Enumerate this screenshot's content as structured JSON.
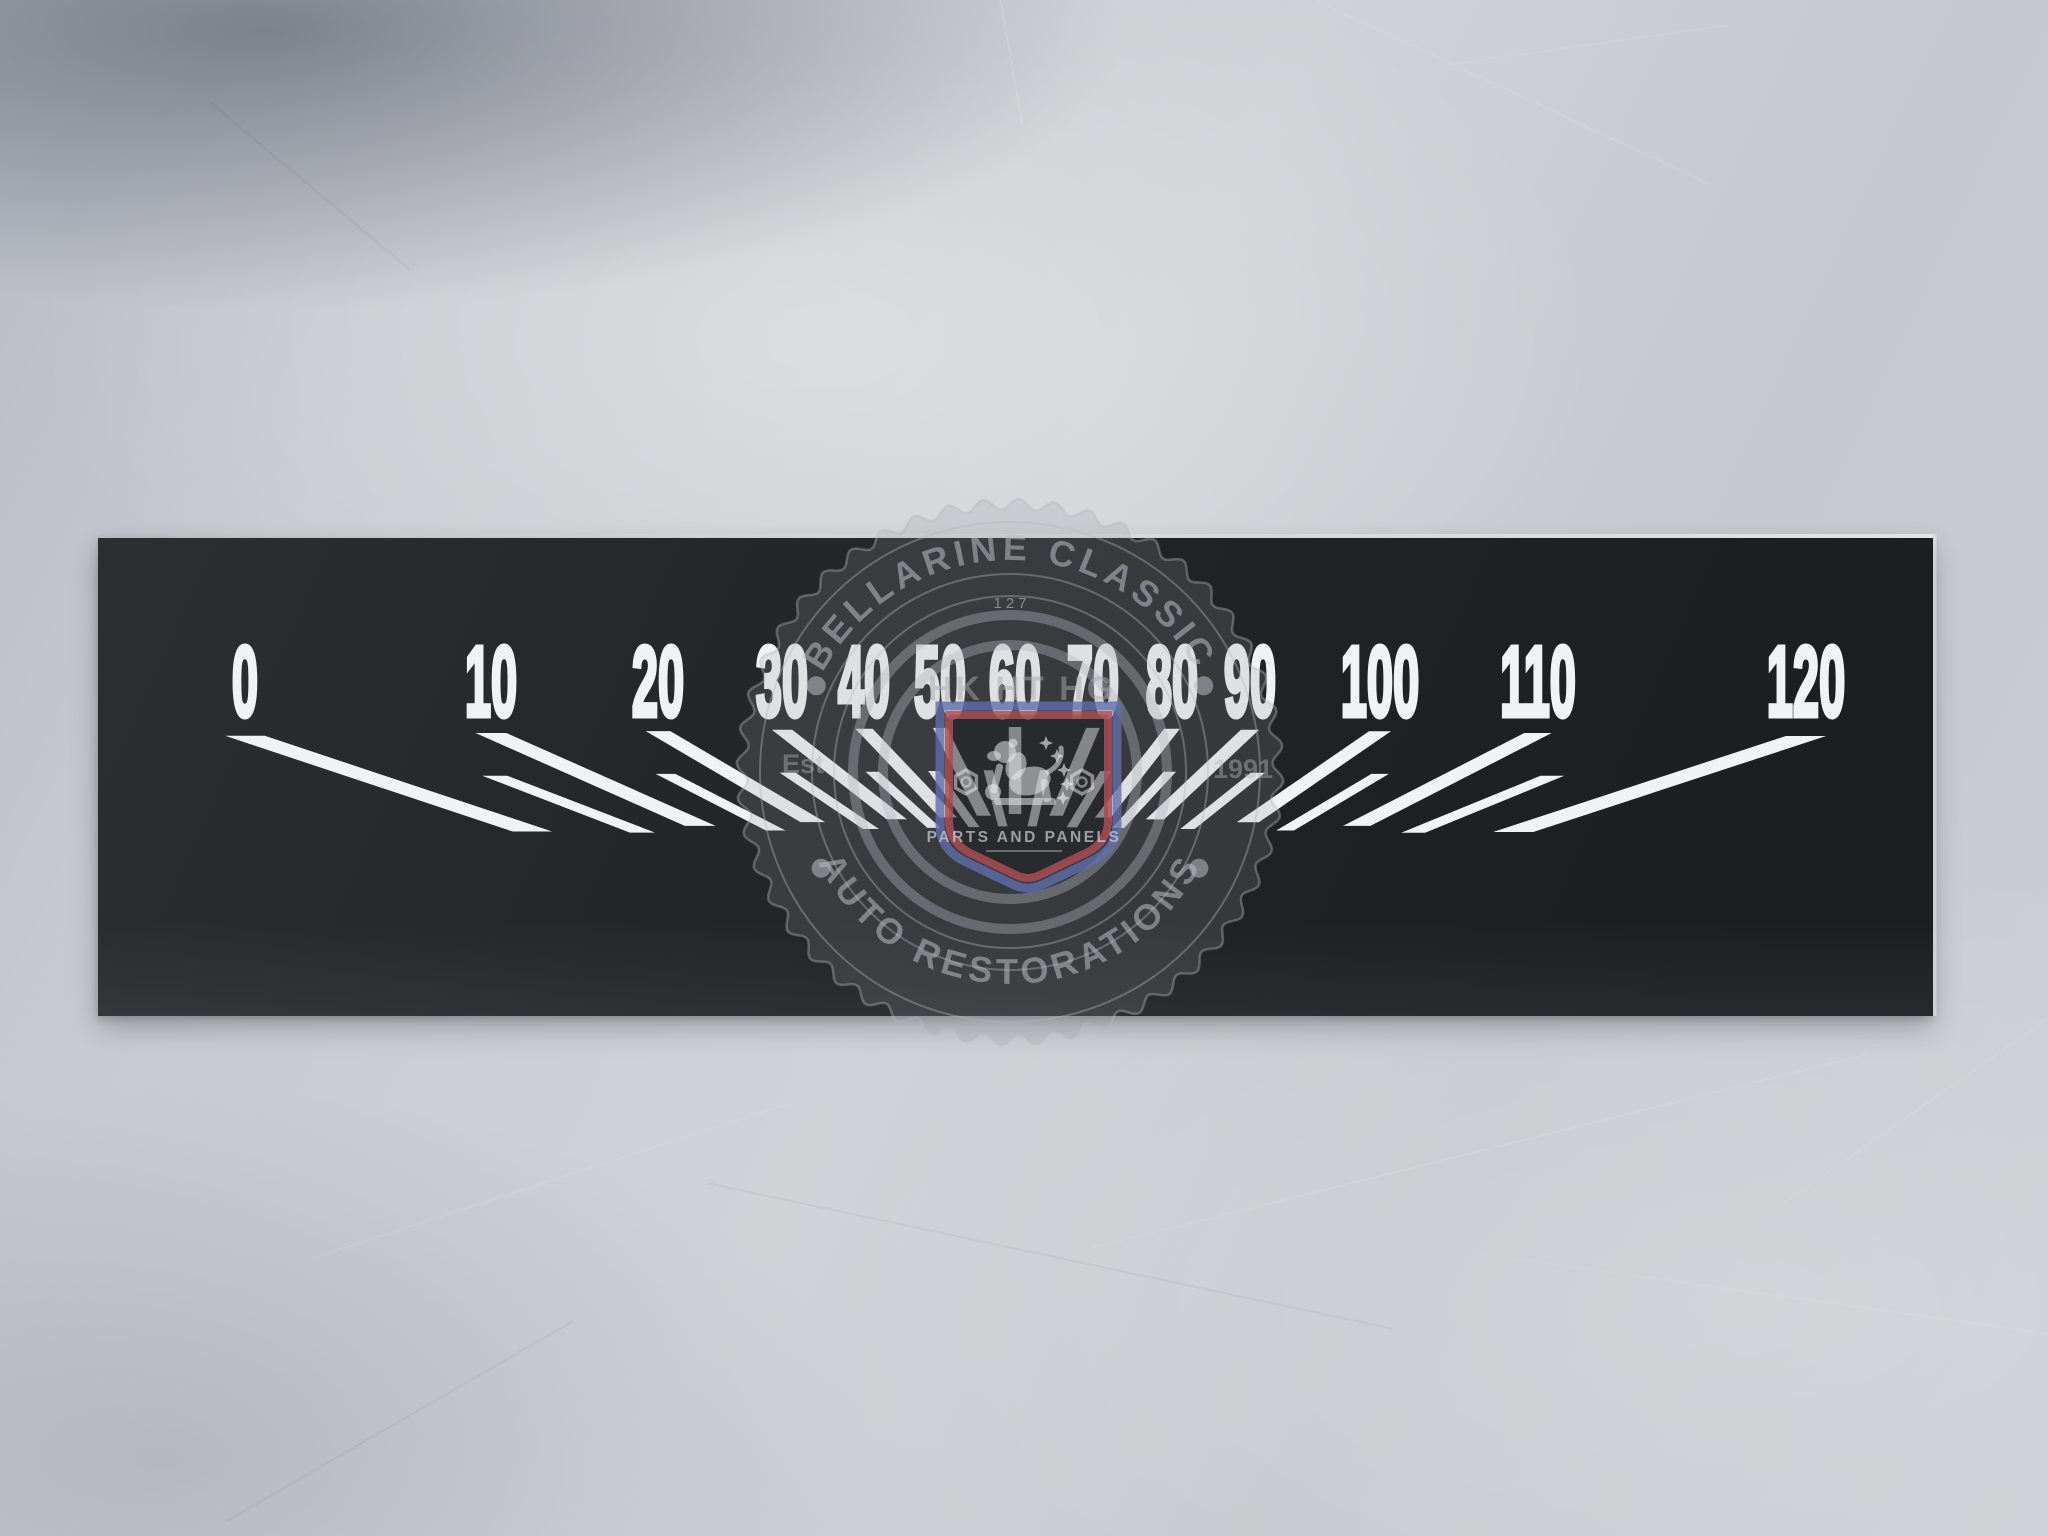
{
  "photo": {
    "subject": "speedometer faceplate decal photographed on brushed aluminium sheet",
    "colors": {
      "background_metal": "#c7cacf",
      "plate_black": "#222427",
      "markings_white": "#f1f2f3"
    }
  },
  "plate": {
    "scale": {
      "labels": [
        {
          "text": "0",
          "x": 245
        },
        {
          "text": "10",
          "x": 491
        },
        {
          "text": "20",
          "x": 658
        },
        {
          "text": "30",
          "x": 782
        },
        {
          "text": "40",
          "x": 864
        },
        {
          "text": "50",
          "x": 940
        },
        {
          "text": "60",
          "x": 1015
        },
        {
          "text": "70",
          "x": 1093
        },
        {
          "text": "80",
          "x": 1172
        },
        {
          "text": "90",
          "x": 1250
        },
        {
          "text": "100",
          "x": 1380
        },
        {
          "text": "110",
          "x": 1538
        },
        {
          "text": "120",
          "x": 1806
        }
      ],
      "ticks": [
        {
          "v": 0,
          "x": 245,
          "slope": 3.0,
          "major": true
        },
        {
          "v": 5,
          "x": 368,
          "slope": 2.6,
          "major": false
        },
        {
          "v": 10,
          "x": 491,
          "slope": 2.25,
          "major": true
        },
        {
          "v": 15,
          "x": 574,
          "slope": 1.95,
          "major": false
        },
        {
          "v": 20,
          "x": 658,
          "slope": 1.7,
          "major": true
        },
        {
          "v": 25,
          "x": 720,
          "slope": 1.48,
          "major": false
        },
        {
          "v": 30,
          "x": 782,
          "slope": 1.28,
          "major": true
        },
        {
          "v": 35,
          "x": 823,
          "slope": 1.1,
          "major": false
        },
        {
          "v": 40,
          "x": 864,
          "slope": 0.95,
          "major": true
        },
        {
          "v": 45,
          "x": 902,
          "slope": 0.72,
          "major": false
        },
        {
          "v": 50,
          "x": 940,
          "slope": 0.5,
          "major": true
        },
        {
          "v": 55,
          "x": 977,
          "slope": 0.26,
          "major": false
        },
        {
          "v": 60,
          "x": 1015,
          "slope": 0.0,
          "major": true
        },
        {
          "v": 65,
          "x": 1054,
          "slope": -0.22,
          "major": false
        },
        {
          "v": 70,
          "x": 1093,
          "slope": -0.42,
          "major": true
        },
        {
          "v": 75,
          "x": 1132,
          "slope": -0.6,
          "major": false
        },
        {
          "v": 80,
          "x": 1172,
          "slope": -0.78,
          "major": true
        },
        {
          "v": 85,
          "x": 1211,
          "slope": -0.92,
          "major": false
        },
        {
          "v": 90,
          "x": 1250,
          "slope": -1.06,
          "major": true
        },
        {
          "v": 95,
          "x": 1315,
          "slope": -1.25,
          "major": false
        },
        {
          "v": 100,
          "x": 1380,
          "slope": -1.45,
          "major": true
        },
        {
          "v": 105,
          "x": 1459,
          "slope": -1.68,
          "major": false
        },
        {
          "v": 110,
          "x": 1538,
          "slope": -1.95,
          "major": true
        },
        {
          "v": 115,
          "x": 1672,
          "slope": -2.45,
          "major": false
        },
        {
          "v": 120,
          "x": 1806,
          "slope": -3.05,
          "major": true
        }
      ],
      "geometry": {
        "strip": {
          "x": 98,
          "y": 538,
          "w": 1835,
          "h": 478
        },
        "label_baseline_y": 716,
        "label_font_size": 100,
        "label_scale_x": 0.47,
        "major_top": 727,
        "major_top_spread": 9,
        "major_bot": 814,
        "major_bot_spread": 18,
        "minor_top": 770,
        "minor_top_spread": 7,
        "minor_bot": 826,
        "minor_bot_spread": 8,
        "major_thickness": 12.5,
        "minor_thickness": 9,
        "center_x": 1015,
        "half_span": 790
      }
    }
  },
  "watermark": {
    "arc_top_text": "BELLARINE CLASSIC",
    "arc_bottom_text": "AUTO RESTORATIONS",
    "serial_number": "127",
    "model_codes": "HK HT HG",
    "established_prefix": "Est",
    "established_year": "1991",
    "badge_caption": "PARTS AND PANELS",
    "center": {
      "x": 1010,
      "y": 772
    },
    "scallop": {
      "radius": 268,
      "amplitude": 5.5,
      "teeth": 48
    },
    "thin_ring_radii": [
      250,
      198,
      176
    ],
    "bold_ring_radii": [
      157,
      127
    ],
    "text_ring_radius": 212,
    "bullet_angles_deg": [
      156,
      24,
      207,
      333
    ],
    "colors": {
      "mark_fill": "rgba(150,154,160,0.20)",
      "mark_line": "rgba(180,185,191,0.38)",
      "mark_text": "rgba(185,190,196,0.55)",
      "badge_blue": "rgba(95,110,170,0.80)",
      "badge_red": "rgba(170,78,84,0.85)",
      "badge_light": "rgba(235,238,241,0.55)"
    }
  }
}
